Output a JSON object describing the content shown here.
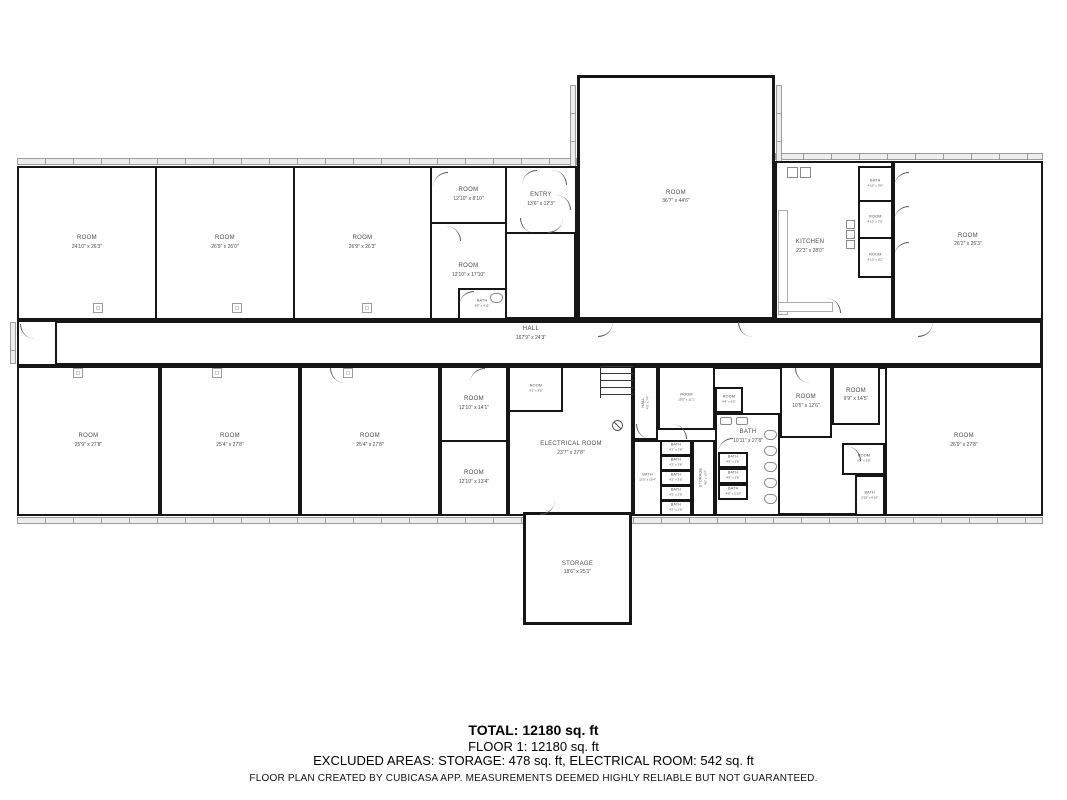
{
  "colors": {
    "wall": "#161616",
    "window_fill": "#ededed",
    "label_text": "#4a4a4a",
    "summary_text": "#000000"
  },
  "plan": {
    "rooms": [
      {
        "name": "ROOM",
        "dims": "24'10\" x 26'3\""
      },
      {
        "name": "ROOM",
        "dims": "26'9\" x 26'0\""
      },
      {
        "name": "ROOM",
        "dims": "26'9\" x 26'3\""
      },
      {
        "name": "ROOM",
        "dims": "12'10\" x 8'10\""
      },
      {
        "name": "ROOM",
        "dims": "12'10\" x 17'10\""
      },
      {
        "name": "BATH",
        "dims": "8'5\" x 4'11\""
      },
      {
        "name": "ENTRY",
        "dims": "13'6\" x 12'3\""
      },
      {
        "name": "ROOM",
        "dims": "36'7\" x 44'6\""
      },
      {
        "name": "KITCHEN",
        "dims": "22'3\" x 28'0\""
      },
      {
        "name": "BATH",
        "dims": "4'10\" x 5'9\""
      },
      {
        "name": "ROOM",
        "dims": "4'10\" x 7'5\""
      },
      {
        "name": "ROOM",
        "dims": "4'10\" x 6'2\""
      },
      {
        "name": "ROOM",
        "dims": "26'2\" x 26'3\""
      },
      {
        "name": "HALL",
        "dims": "167'9\" x 24'3\""
      },
      {
        "name": "ROOM",
        "dims": "25'9\" x 27'8\""
      },
      {
        "name": "ROOM",
        "dims": "25'4\" x 27'8\""
      },
      {
        "name": "ROOM",
        "dims": "25'4\" x 27'8\""
      },
      {
        "name": "ROOM",
        "dims": "12'10\" x 14'1\""
      },
      {
        "name": "ROOM",
        "dims": "12'10\" x 13'4\""
      },
      {
        "name": "ROOM",
        "dims": "9'1\" x 8'0\""
      },
      {
        "name": "ELECTRICAL ROOM",
        "dims": "23'7\" x 27'8\""
      },
      {
        "name": "HALL",
        "dims": "4'5\" x 7'4\""
      },
      {
        "name": "ROOM",
        "dims": "10'5\" x 11'1\""
      },
      {
        "name": "ROOM",
        "dims": "4'4\" x 6'3\""
      },
      {
        "name": "BATH",
        "dims": "11'0\" x 16'4\""
      },
      {
        "name": "BATH",
        "dims": "4'2\" x 2'6\""
      },
      {
        "name": "STORAGE",
        "dims": "4'5\" x 13'7\""
      },
      {
        "name": "BATH",
        "dims": "4'9\" x 2'6\""
      },
      {
        "name": "BATH",
        "dims": "4'9\" x 2'10\""
      },
      {
        "name": "BATH",
        "dims": "10'11\" x 27'8\""
      },
      {
        "name": "ROOM",
        "dims": "10'5\" x 12'6\""
      },
      {
        "name": "ROOM",
        "dims": "9'9\" x 14'5\""
      },
      {
        "name": "ROOM",
        "dims": "8'2\" x 5'5\""
      },
      {
        "name": "BATH",
        "dims": "3'10\" x 6'10\""
      },
      {
        "name": "ROOM",
        "dims": "26'9\" x 27'8\""
      },
      {
        "name": "STORAGE",
        "dims": "18'6\" x 25'1\""
      }
    ]
  },
  "summary": {
    "total": "TOTAL: 12180 sq. ft",
    "floor": "FLOOR 1: 12180 sq. ft",
    "excluded": "EXCLUDED AREAS: STORAGE: 478 sq. ft, ELECTRICAL ROOM: 542 sq. ft",
    "disclaimer": "FLOOR PLAN CREATED BY CUBICASA APP. MEASUREMENTS DEEMED HIGHLY RELIABLE BUT NOT GUARANTEED."
  }
}
